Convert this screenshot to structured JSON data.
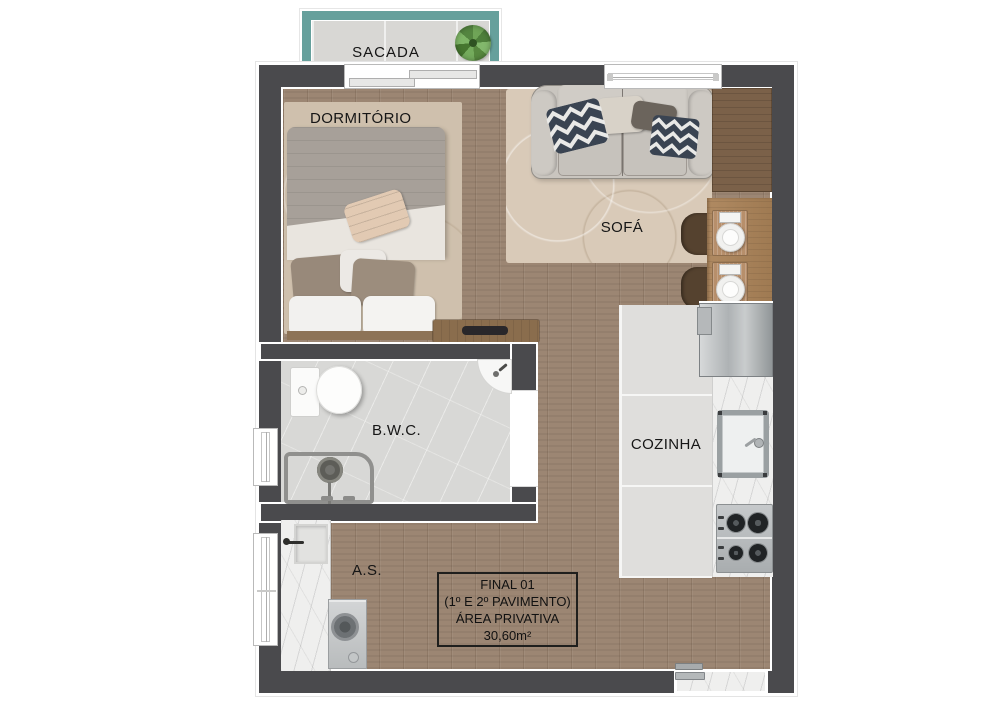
{
  "plan": {
    "rooms": {
      "balcony": {
        "label": "SACADA"
      },
      "bedroom": {
        "label": "DORMITÓRIO"
      },
      "living": {
        "label": "SOFÁ"
      },
      "bathroom": {
        "label": "B.W.C."
      },
      "kitchen": {
        "label": "COZINHA"
      },
      "laundry": {
        "label": "A.S."
      }
    },
    "info_box": {
      "unit": "FINAL 01",
      "floors": "(1º E 2º PAVIMENTO)",
      "area_label": "ÁREA PRIVATIVA",
      "area_value": "30,60m²"
    },
    "fixtures": {
      "balcony": [
        "plant"
      ],
      "bedroom": [
        "double-bed",
        "tv-console"
      ],
      "living": [
        "sofa",
        "chevron-pillows",
        "dining-table",
        "chairs",
        "place-settings"
      ],
      "kitchen": [
        "refrigerator",
        "sink",
        "cooktop",
        "counter"
      ],
      "bathroom": [
        "toilet",
        "corner-sink",
        "shower"
      ],
      "laundry": [
        "laundry-sink",
        "washing-machine"
      ]
    },
    "colors": {
      "wall": "#4a4a4d",
      "balcony_accent": "#66a09c",
      "wood_floor": "#9c8673",
      "kitchen_tile": "#dfdedc",
      "bathroom_floor": "#d8d8d6",
      "marble_counter": "#efefee",
      "living_rug": "#d9cab8",
      "bedroom_rug": "#cfc0ad",
      "pillow_navy": "#3a4452"
    }
  }
}
